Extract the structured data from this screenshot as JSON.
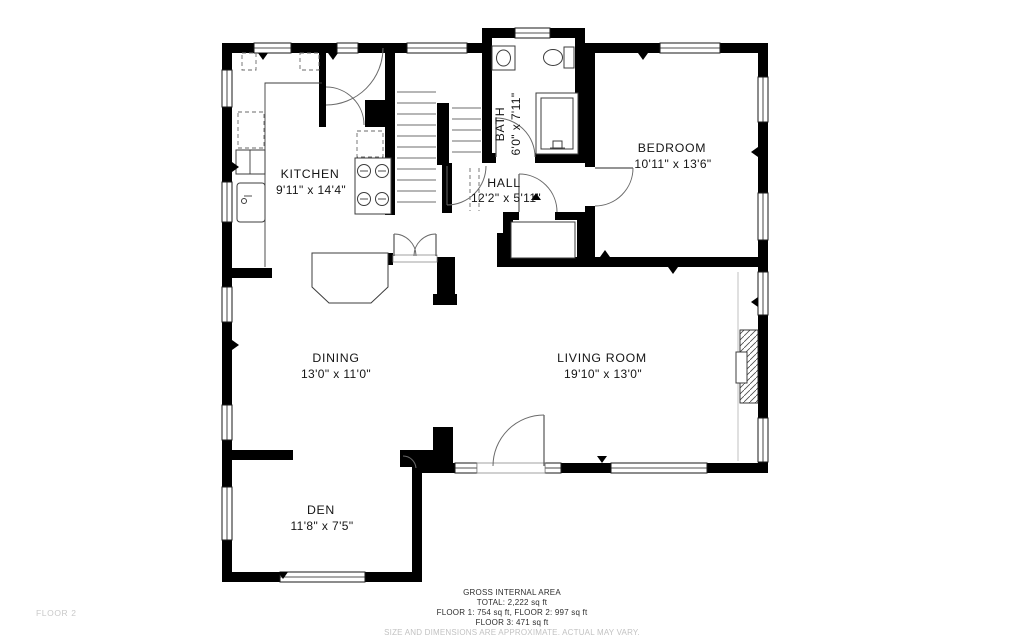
{
  "page": {
    "background": "#ffffff"
  },
  "floor_label": "FLOOR 2",
  "rooms": [
    {
      "id": "kitchen",
      "name": "KITCHEN",
      "dims": "9'11\" x 14'4\""
    },
    {
      "id": "bath",
      "name": "BATH",
      "dims": "6'0\" x 7'11\""
    },
    {
      "id": "hall",
      "name": "HALL",
      "dims": "12'2\" x 5'11\""
    },
    {
      "id": "bedroom",
      "name": "BEDROOM",
      "dims": "10'11\" x 13'6\""
    },
    {
      "id": "dining",
      "name": "DINING",
      "dims": "13'0\" x 11'0\""
    },
    {
      "id": "living_room",
      "name": "LIVING ROOM",
      "dims": "19'10\" x 13'0\""
    },
    {
      "id": "den",
      "name": "DEN",
      "dims": "11'8\" x 7'5\""
    }
  ],
  "footer": {
    "title": "GROSS INTERNAL AREA",
    "total_line": "TOTAL: 2,222 sq ft",
    "floors_line": "FLOOR 1: 754 sq ft, FLOOR 2: 997 sq ft",
    "floor3_line": "FLOOR 3: 471 sq ft",
    "disclaimer": "SIZE AND DIMENSIONS ARE APPROXIMATE. ACTUAL MAY VARY."
  },
  "colors": {
    "walls": "#000000",
    "fixtures": "#3c3c3c",
    "text": "#151515",
    "muted_text": "#c9c9c9"
  }
}
